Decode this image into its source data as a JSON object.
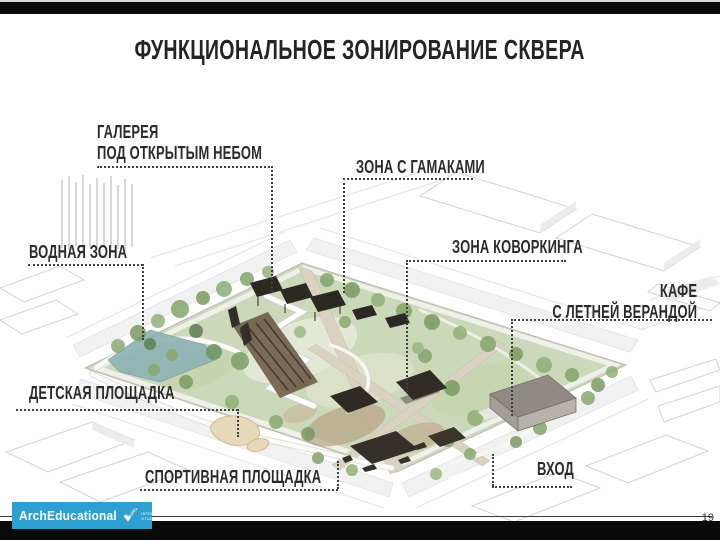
{
  "slide": {
    "title": "ФУНКЦИОНАЛЬНОЕ ЗОНИРОВАНИЕ СКВЕРА",
    "page_number": "19",
    "labels": {
      "gallery_line1": "ГАЛЕРЕЯ",
      "gallery_line2": "ПОД ОТКРЫТЫМ НЕБОМ",
      "hammocks": "ЗОНА С ГАМАКАМИ",
      "water": "ВОДНАЯ ЗОНА",
      "coworking": "ЗОНА КОВОРКИНГА",
      "cafe_line1": "КАФЕ",
      "cafe_line2": "С ЛЕТНЕЙ ВЕРАНДОЙ",
      "children": "ДЕТСКАЯ ПЛОЩАДКА",
      "sport": "СПОРТИВНАЯ ПЛОЩАДКА",
      "entrance": "ВХОД"
    },
    "logo": {
      "name": "ArchEducational",
      "year": "2020",
      "tagline_line1": "INTERNATIONAL",
      "tagline_line2": "STUDENT CONTEST",
      "bg_color": "#2d9fd0"
    },
    "colors": {
      "text": "#2b2b2b",
      "leader_dots": "#3f3f3f",
      "park_green": "#ccd8ba",
      "pond": "#8db2b3",
      "structures_dark": "#2e2a25",
      "cafe_building": "#a7a39b",
      "road": "#f1f1f1",
      "sand": "#e7d8ba"
    }
  }
}
